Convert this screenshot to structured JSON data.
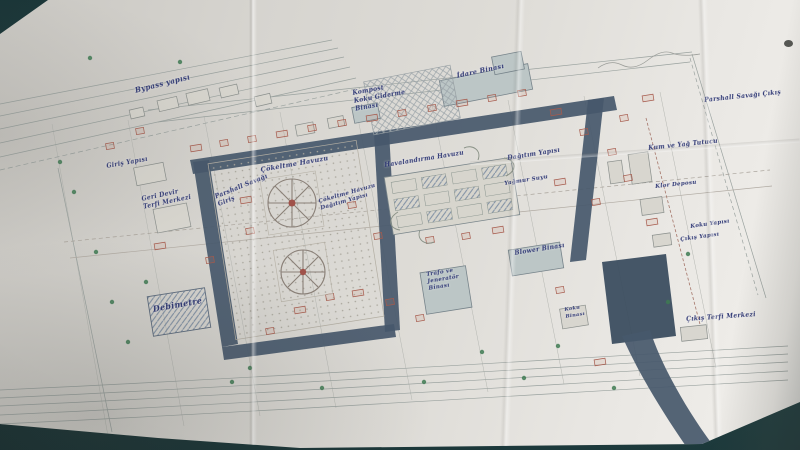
{
  "photo": {
    "backdrop_color": "#1d393b",
    "paper_color": "#d6d4cf",
    "ink_color": "#2b3472",
    "road_color": "#46586b",
    "print_red": "#a65a4c",
    "print_green": "#3e7a52"
  },
  "plan": {
    "labels": [
      {
        "name": "label-bypass-yapisi",
        "lines": [
          "Bypass yapısı"
        ],
        "x": 134,
        "y": 86,
        "rot": -14,
        "size": 7
      },
      {
        "name": "label-kompost-koku-giderme-binasi",
        "lines": [
          "Kompost",
          "Koku Giderme",
          "Binası"
        ],
        "x": 352,
        "y": 90,
        "rot": -10,
        "size": 6
      },
      {
        "name": "label-idare-binasi",
        "lines": [
          "İdare Binası"
        ],
        "x": 456,
        "y": 72,
        "rot": -12,
        "size": 6.5
      },
      {
        "name": "label-parshall-savagi-cikis",
        "lines": [
          "Parshall Savağı Çıkış"
        ],
        "x": 704,
        "y": 97,
        "rot": -6,
        "size": 6
      },
      {
        "name": "label-kum-ve-yag-tutucu",
        "lines": [
          "Kum ve Yağ Tutucu"
        ],
        "x": 648,
        "y": 145,
        "rot": -6,
        "size": 6
      },
      {
        "name": "label-klor-deposu",
        "lines": [
          "Klor Deposu"
        ],
        "x": 655,
        "y": 184,
        "rot": -6,
        "size": 5.5
      },
      {
        "name": "label-koku-yapisi",
        "lines": [
          "Koku Yapısı"
        ],
        "x": 690,
        "y": 224,
        "rot": -8,
        "size": 5.5
      },
      {
        "name": "label-cikis-yapisi",
        "lines": [
          "Çıkış Yapısı"
        ],
        "x": 680,
        "y": 237,
        "rot": -8,
        "size": 5.5
      },
      {
        "name": "label-giris-yapisi",
        "lines": [
          "Giriş Yapısı"
        ],
        "x": 106,
        "y": 163,
        "rot": -10,
        "size": 6
      },
      {
        "name": "label-geri-devir-terfi-merkezi",
        "lines": [
          "Geri Devir",
          "Terfi Merkezi"
        ],
        "x": 141,
        "y": 196,
        "rot": -12,
        "size": 6
      },
      {
        "name": "label-cokeltme-havuzu",
        "lines": [
          "Çökeltme Havuzu"
        ],
        "x": 260,
        "y": 166,
        "rot": -10,
        "size": 6.5
      },
      {
        "name": "label-parshall-savagi-giris",
        "lines": [
          "Parshall Savağı",
          "Giriş"
        ],
        "x": 214,
        "y": 194,
        "rot": -22,
        "size": 6
      },
      {
        "name": "label-cokeltme-dagitim-yapisi",
        "lines": [
          "Çökeltme Havuzu",
          "Dağıtım Yapısı"
        ],
        "x": 318,
        "y": 199,
        "rot": -16,
        "size": 5.5
      },
      {
        "name": "label-havalandirma-havuzu",
        "lines": [
          "Havalandırma Havuzu"
        ],
        "x": 384,
        "y": 162,
        "rot": -9,
        "size": 6
      },
      {
        "name": "label-dagitim-yapisi",
        "lines": [
          "Dağıtım Yapısı"
        ],
        "x": 507,
        "y": 155,
        "rot": -9,
        "size": 6
      },
      {
        "name": "label-yagmur-suyu",
        "lines": [
          "Yağmur Suyu"
        ],
        "x": 504,
        "y": 181,
        "rot": -9,
        "size": 5.5
      },
      {
        "name": "label-debimetre",
        "lines": [
          "Debimetre"
        ],
        "x": 152,
        "y": 304,
        "rot": -10,
        "size": 8
      },
      {
        "name": "label-blower-binasi",
        "lines": [
          "Blower Binası"
        ],
        "x": 514,
        "y": 250,
        "rot": -9,
        "size": 6
      },
      {
        "name": "label-trafo-jenerator-binasi",
        "lines": [
          "Trafo ve",
          "Jeneratör",
          "Binası"
        ],
        "x": 426,
        "y": 272,
        "rot": -9,
        "size": 5.5
      },
      {
        "name": "label-koku-binasi",
        "lines": [
          "Koku",
          "Binası"
        ],
        "x": 564,
        "y": 307,
        "rot": -9,
        "size": 5
      },
      {
        "name": "label-cikis-terfi-merkezi",
        "lines": [
          "Çıkış Terfi Merkezi"
        ],
        "x": 686,
        "y": 316,
        "rot": -4,
        "size": 6
      }
    ],
    "buildings": [
      {
        "name": "idare-binasi",
        "cx": 486,
        "cy": 85,
        "w": 90,
        "h": 26,
        "rot": -11,
        "type": "shaded"
      },
      {
        "name": "kompost-alani",
        "cx": 412,
        "cy": 100,
        "w": 88,
        "h": 54,
        "rot": -11,
        "type": "hatchx"
      },
      {
        "name": "koku-giderme-yapisi",
        "cx": 366,
        "cy": 113,
        "w": 26,
        "h": 16,
        "rot": -11,
        "type": "shaded"
      },
      {
        "name": "cati-yapisi",
        "cx": 508,
        "cy": 63,
        "w": 30,
        "h": 18,
        "rot": -11,
        "type": "shaded"
      },
      {
        "name": "havalandirma-havuzu",
        "cx": 452,
        "cy": 196,
        "w": 128,
        "h": 58,
        "rot": -9,
        "type": "grid"
      },
      {
        "name": "cokeltme-alani",
        "cx": 296,
        "cy": 240,
        "w": 150,
        "h": 178,
        "rot": -9,
        "type": "dotted"
      },
      {
        "name": "debimetre-binasi",
        "cx": 179,
        "cy": 312,
        "w": 58,
        "h": 40,
        "rot": -9,
        "type": "hatch"
      },
      {
        "name": "blower-binasi",
        "cx": 536,
        "cy": 259,
        "w": 52,
        "h": 26,
        "rot": -9,
        "type": "shaded"
      },
      {
        "name": "trafo-jenerator-binasi",
        "cx": 446,
        "cy": 290,
        "w": 46,
        "h": 42,
        "rot": -9,
        "type": "shaded"
      },
      {
        "name": "koku-binasi",
        "cx": 574,
        "cy": 317,
        "w": 26,
        "h": 20,
        "rot": -9,
        "type": "light"
      },
      {
        "name": "giris-yapisi",
        "cx": 150,
        "cy": 174,
        "w": 30,
        "h": 18,
        "rot": -11,
        "type": "light"
      },
      {
        "name": "geri-devir-yapisi",
        "cx": 172,
        "cy": 218,
        "w": 34,
        "h": 24,
        "rot": -11,
        "type": "light"
      },
      {
        "name": "kum-yag-tutucu",
        "cx": 640,
        "cy": 168,
        "w": 20,
        "h": 30,
        "rot": -8,
        "type": "light"
      },
      {
        "name": "kum-yag-tutucu-2",
        "cx": 616,
        "cy": 172,
        "w": 14,
        "h": 22,
        "rot": -8,
        "type": "light"
      },
      {
        "name": "klor-deposu-yapisi",
        "cx": 652,
        "cy": 206,
        "w": 22,
        "h": 16,
        "rot": -8,
        "type": "light"
      },
      {
        "name": "cikis-yapisi",
        "cx": 662,
        "cy": 240,
        "w": 18,
        "h": 12,
        "rot": -8,
        "type": "light"
      },
      {
        "name": "cikis-terfi-yapisi",
        "cx": 694,
        "cy": 333,
        "w": 26,
        "h": 14,
        "rot": -6,
        "type": "light"
      },
      {
        "name": "bypass-yapisi-1",
        "cx": 137,
        "cy": 113,
        "w": 14,
        "h": 9,
        "rot": -13,
        "type": "light"
      },
      {
        "name": "bypass-yapisi-2",
        "cx": 168,
        "cy": 104,
        "w": 20,
        "h": 11,
        "rot": -13,
        "type": "light"
      },
      {
        "name": "bypass-yapisi-3",
        "cx": 198,
        "cy": 97,
        "w": 22,
        "h": 12,
        "rot": -13,
        "type": "light"
      },
      {
        "name": "bypass-yapisi-4",
        "cx": 229,
        "cy": 91,
        "w": 18,
        "h": 10,
        "rot": -13,
        "type": "light"
      },
      {
        "name": "bypass-yapisi-5",
        "cx": 263,
        "cy": 100,
        "w": 16,
        "h": 10,
        "rot": -13,
        "type": "light"
      },
      {
        "name": "ara-yapi-1",
        "cx": 305,
        "cy": 129,
        "w": 18,
        "h": 11,
        "rot": -11,
        "type": "light"
      },
      {
        "name": "ara-yapi-2",
        "cx": 336,
        "cy": 122,
        "w": 16,
        "h": 10,
        "rot": -11,
        "type": "light"
      }
    ],
    "red_markers": [
      [
        196,
        148
      ],
      [
        224,
        143
      ],
      [
        252,
        139
      ],
      [
        282,
        134
      ],
      [
        312,
        128
      ],
      [
        342,
        123
      ],
      [
        372,
        118
      ],
      [
        402,
        113
      ],
      [
        432,
        108
      ],
      [
        462,
        103
      ],
      [
        492,
        98
      ],
      [
        522,
        93
      ],
      [
        556,
        112
      ],
      [
        584,
        132
      ],
      [
        612,
        152
      ],
      [
        560,
        182
      ],
      [
        596,
        202
      ],
      [
        628,
        178
      ],
      [
        652,
        222
      ],
      [
        430,
        240
      ],
      [
        466,
        236
      ],
      [
        498,
        230
      ],
      [
        420,
        318
      ],
      [
        390,
        302
      ],
      [
        358,
        293
      ],
      [
        330,
        297
      ],
      [
        560,
        290
      ],
      [
        600,
        362
      ],
      [
        250,
        231
      ],
      [
        210,
        260
      ],
      [
        160,
        246
      ],
      [
        140,
        131
      ],
      [
        110,
        146
      ],
      [
        246,
        200
      ],
      [
        352,
        205
      ],
      [
        378,
        236
      ],
      [
        300,
        310
      ],
      [
        270,
        331
      ],
      [
        624,
        118
      ],
      [
        648,
        98
      ]
    ],
    "tree_markers": [
      [
        74,
        192
      ],
      [
        96,
        252
      ],
      [
        112,
        302
      ],
      [
        128,
        342
      ],
      [
        232,
        382
      ],
      [
        322,
        388
      ],
      [
        424,
        382
      ],
      [
        524,
        378
      ],
      [
        614,
        388
      ],
      [
        688,
        254
      ],
      [
        60,
        162
      ],
      [
        146,
        282
      ],
      [
        668,
        302
      ],
      [
        558,
        346
      ],
      [
        482,
        352
      ],
      [
        180,
        62
      ],
      [
        90,
        58
      ],
      [
        250,
        368
      ]
    ]
  }
}
